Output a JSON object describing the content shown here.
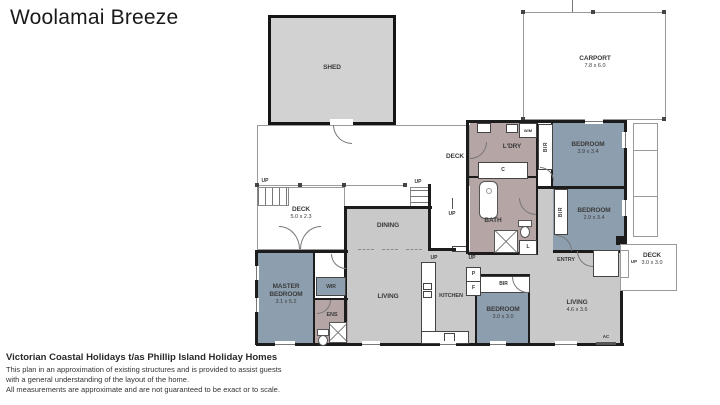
{
  "title": "Woolamai Breeze",
  "rooms": {
    "shed": {
      "label": "SHED"
    },
    "carport": {
      "label": "CARPORT",
      "dims": "7.8 x 6.0"
    },
    "deck_main": {
      "label": "DECK"
    },
    "deck_left": {
      "label": "DECK",
      "dims": "5.0 x 2.3"
    },
    "deck_right": {
      "label": "DECK",
      "dims": "3.0 x 3.0"
    },
    "laundry": {
      "label": "L'DRY"
    },
    "bedroom_1": {
      "label": "BEDROOM",
      "dims": "3.9 x 3.4"
    },
    "bedroom_2": {
      "label": "BEDROOM",
      "dims": "2.9 x 3.4"
    },
    "bedroom_3": {
      "label": "BEDROOM",
      "dims": "3.0 x 3.0"
    },
    "master_bedroom": {
      "label": "MASTER BEDROOM",
      "dims": "3.1 x 5.2"
    },
    "bath": {
      "label": "BATH"
    },
    "ensuite": {
      "label": "ENS"
    },
    "wir": {
      "label": "WIR"
    },
    "dining": {
      "label": "DINING"
    },
    "living_main": {
      "label": "LIVING"
    },
    "kitchen": {
      "label": "KITCHEN"
    },
    "living_2": {
      "label": "LIVING",
      "dims": "4.6 x 3.6"
    },
    "entry": {
      "label": "ENTRY"
    }
  },
  "tags": {
    "wm": "W/M",
    "bir": "BIR",
    "c": "C",
    "l": "L",
    "p": "P",
    "f": "F",
    "up": "UP",
    "ac": "AC"
  },
  "footer": {
    "company": "Victorian Coastal Holidays t/as Phillip Island Holiday Homes",
    "disclaimer_1": "This plan in an approximation of existing structures and is provided to assist guests",
    "disclaimer_2": "with a general understanding of the layout of the home.",
    "disclaimer_3": "All measurements are approximate and are not guaranteed to be exact or to scale."
  },
  "colors": {
    "bedroom_fill": "#8d9fae",
    "open_plan_fill": "#c9c9c9",
    "wet_area_fill": "#b5a5a4",
    "shed_fill": "#d2d2d2",
    "wall": "#1c1c1c"
  }
}
